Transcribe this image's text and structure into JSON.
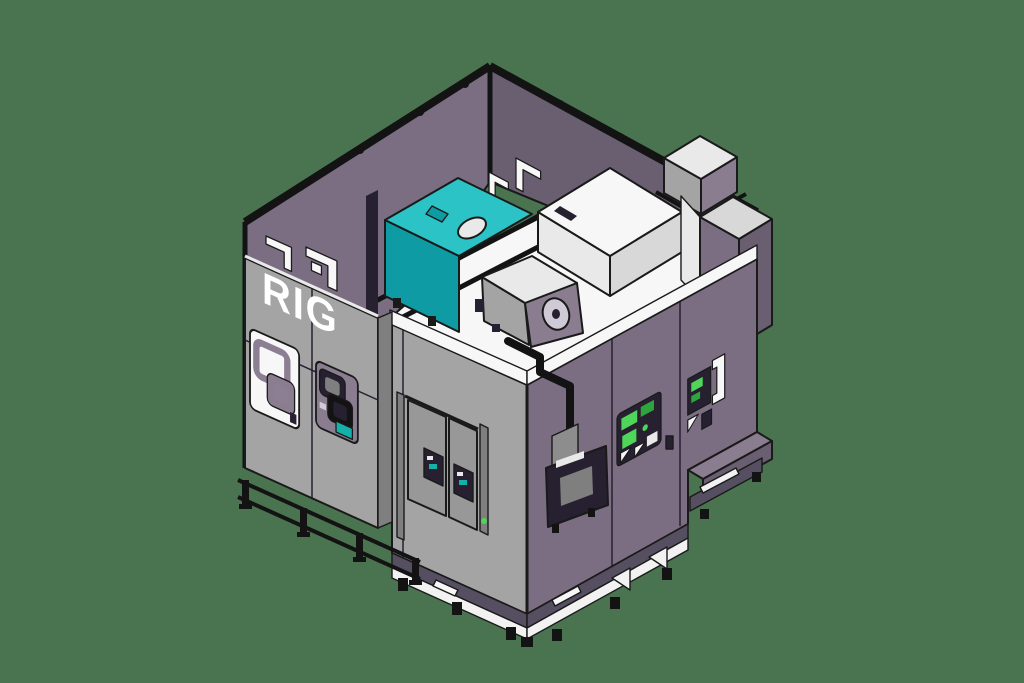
{
  "scene": {
    "type": "isometric-cad-render",
    "description": "3D CAD rendering of an industrial RIG test-chamber enclosure on a green background",
    "background_color": "#4a7450"
  },
  "machine": {
    "brand_label": "RIG",
    "colors": {
      "background": "#4a7450",
      "edge": "#1a1a1a",
      "black": "#131313",
      "dark": "#262030",
      "white": "#f7f7f7",
      "light": "#e9e9e9",
      "midlight": "#d8d8d8",
      "gray": "#a4a4a4",
      "gray2": "#989898",
      "gray3": "#7f7f7f",
      "purple": "#7b6e82",
      "purple2": "#6a5e71",
      "purple3": "#564e61",
      "purple4": "#8a7d90",
      "framepurple": "#8d7f93",
      "teal": "#2cc3c6",
      "teal2": "#0f9ba3",
      "teal3": "#15b1a9",
      "green": "#4fd65a",
      "green2": "#2ea43d",
      "dial": "#d0cad7",
      "skid": "#f2f2f2",
      "patch": "#8d8d8d",
      "logo": "#ffffff"
    }
  }
}
